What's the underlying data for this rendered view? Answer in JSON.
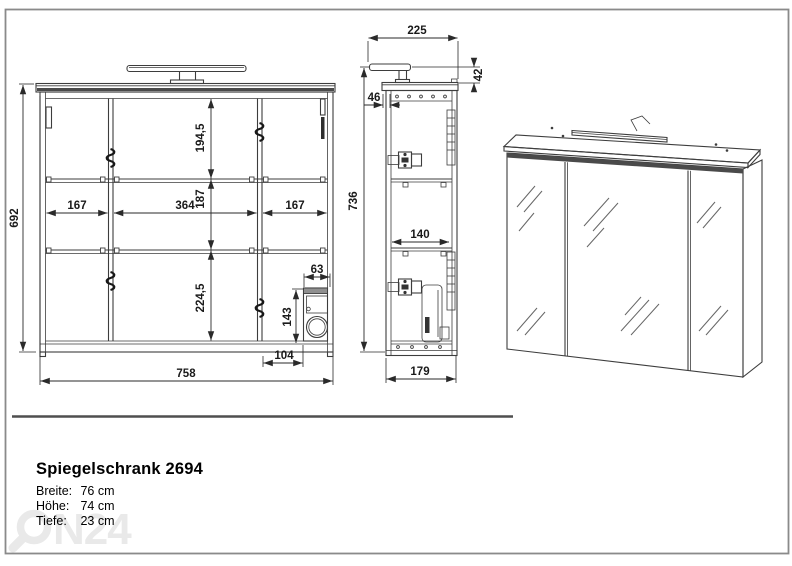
{
  "front_view": {
    "height": "692",
    "width": "758",
    "section_top": "194,5",
    "section_middle": "187",
    "section_bottom": "224,5",
    "comp_left": "167",
    "comp_center": "364",
    "comp_right": "167",
    "socket_width": "63",
    "socket_height": "143",
    "socket_offset": "104"
  },
  "side_view": {
    "depth_with_lamp": "225",
    "lamp_height": "42",
    "front_gap": "46",
    "total_height": "736",
    "inner_depth": "140",
    "depth": "179"
  },
  "info": {
    "title": "Spiegelschrank 2694",
    "specs": [
      {
        "label": "Breite:",
        "value": "76 cm"
      },
      {
        "label": "Höhe:",
        "value": "74 cm"
      },
      {
        "label": "Tiefe:",
        "value": "23 cm"
      }
    ]
  },
  "watermark": {
    "text": "N24"
  },
  "colors": {
    "line": "#3d3d3d",
    "dimension": "#2a2a2a",
    "frame": "#8a8a8a",
    "band": "#4a4a4a",
    "watermark": "#e9e9e9"
  }
}
